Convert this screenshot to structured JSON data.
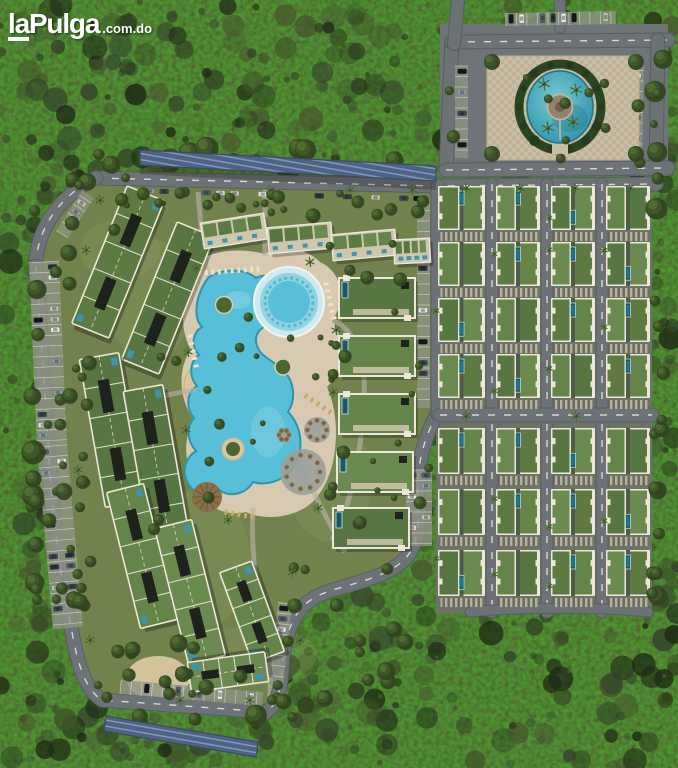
{
  "watermark": {
    "prefix": "la",
    "name": "Pulga",
    "tld": ".com.do"
  },
  "scene": {
    "title": "Tropical resort residential masterplan - aerial rendering",
    "environment": "dense tropical forest surrounding the development",
    "villa_grid": {
      "columns": 4,
      "rows": 7
    },
    "apartment_clusters": 4,
    "townhouse_rows_top": 4,
    "townhouse_blocks_east": 5,
    "amenities": [
      "freeform-lagoon-pool",
      "round-kids-pool",
      "entrance-fountain-plaza",
      "swim-up-bar-palapa",
      "umbrella-courts",
      "sand-beach-areas",
      "solar-carport-north",
      "solar-carport-south",
      "perimeter-parking"
    ]
  },
  "colors": {
    "forest_base": "#2c3a23",
    "forest_dark": "#1e2a16",
    "forest_mid": "#33432a",
    "forest_light": "#47592e",
    "forest_highlight": "#5d7639",
    "grass": "#72824c",
    "grass_light": "#8a9a60",
    "road": "#6d7276",
    "road_edge": "#585e62",
    "road_marking": "#e9e9e0",
    "parking": "#8d9383",
    "deck": "#d7cab0",
    "sand": "#d8c69e",
    "pool": "#57c0d8",
    "pool_deep": "#2e93ae",
    "pool_shallow": "#8ed5e3",
    "pool_rim": "#f2f5ef",
    "villa_pool": "#15596b",
    "villa_pool_light": "#2a8396",
    "roof_green": "#5c7a41",
    "roof_trim": "#ece7d6",
    "roof_dark": "#1d221c",
    "rooftile_blue": "#3f93aa",
    "solar": "#4f6386",
    "solar_line": "#8198bb",
    "palapa": "#8a6f4a",
    "palapa_dark": "#6e5738",
    "hedge": "#2b4522",
    "pave": "#c9bda6",
    "pave_dark": "#b5a78c",
    "pond_outer": "#2e8fa3",
    "pond_inner": "#7ccbd1",
    "island": "#93836a",
    "island_core": "#6b5f49",
    "car_colors": [
      "#e9e9e7",
      "#d6d8d6",
      "#2a3440",
      "#55606a",
      "#14181e",
      "#c9c4b8",
      "#93a0ab",
      "#3a4750"
    ]
  }
}
